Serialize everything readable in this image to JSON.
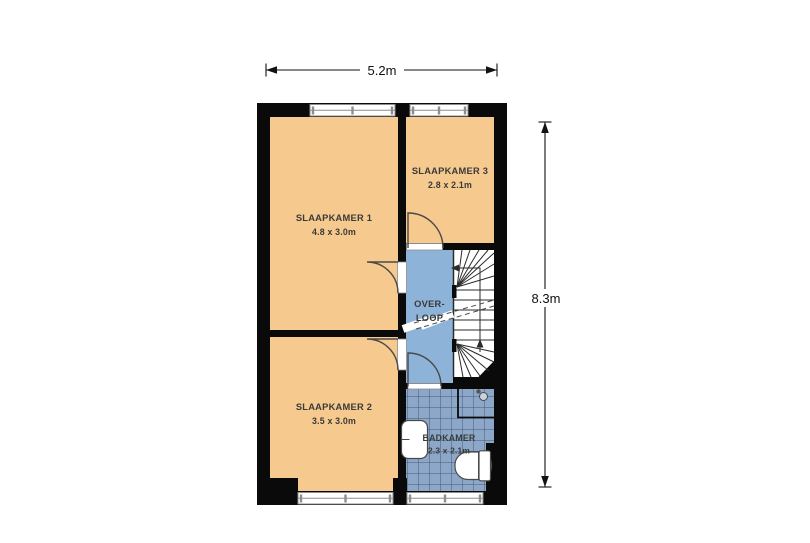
{
  "plan": {
    "dimension_width": {
      "label": "5.2m"
    },
    "dimension_height": {
      "label": "8.3m"
    },
    "rooms": {
      "slaapkamer1": {
        "name": "SLAAPKAMER 1",
        "size": "4.8 x 3.0m"
      },
      "slaapkamer2": {
        "name": "SLAAPKAMER 2",
        "size": "3.5 x 3.0m"
      },
      "slaapkamer3": {
        "name": "SLAAPKAMER 3",
        "size": "2.8 x 2.1m"
      },
      "overloop": {
        "name_line1": "OVER-",
        "name_line2": "LOOP"
      },
      "badkamer": {
        "name": "BADKAMER",
        "size": "2.3 x 2.1m"
      }
    },
    "colors": {
      "bedroom_fill": "#f6c98e",
      "landing_fill": "#8eb3d8",
      "landing_border": "#6d92b8",
      "bathroom_tile": "#8ca7c7",
      "bathroom_grout": "#46597a",
      "wall": "#0a0a0a",
      "door_stroke": "#4a4a4a",
      "fixture_stroke": "#4a4a4a",
      "stair_stroke": "#2b2b2b",
      "stairs_fill": "#ffffff",
      "window_frame": "#8e8e8e",
      "label_text": "#3a3a3a",
      "dimension_color": "#111111"
    }
  }
}
